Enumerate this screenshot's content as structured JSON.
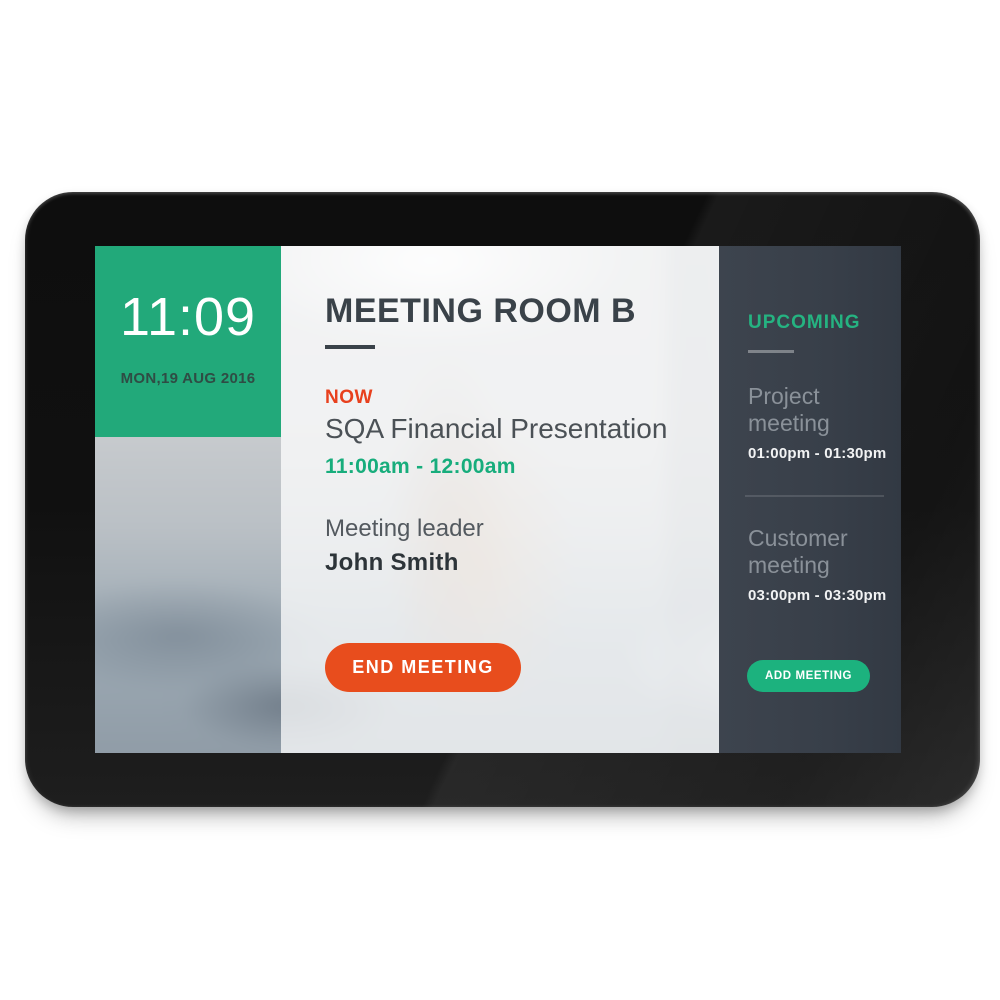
{
  "device": {
    "label": "meeting room booking display"
  },
  "clock": {
    "time": "11:09",
    "date": "MON,19 AUG 2016"
  },
  "room": {
    "title": "MEETING ROOM B"
  },
  "current_meeting": {
    "status_label": "NOW",
    "title": "SQA Financial Presentation",
    "time": "11:00am - 12:00am",
    "leader_label": "Meeting leader",
    "leader_name": "John Smith",
    "end_button_label": "END MEETING"
  },
  "upcoming": {
    "header": "UPCOMING",
    "meetings": [
      {
        "title": "Project meeting",
        "time": "01:00pm - 01:30pm"
      },
      {
        "title": "Customer meeting",
        "time": "03:00pm - 03:30pm"
      }
    ],
    "add_button_label": "ADD MEETING"
  },
  "colors": {
    "clock_panel_green": "#22a97a",
    "accent_green_text": "#17ad7c",
    "upcoming_green": "#25b381",
    "add_button_green": "#1cb27e",
    "now_red": "#e8401d",
    "end_button_red": "#e84d1d",
    "sidebar_dark": "#3a414b",
    "title_dark": "#3a4249",
    "bezel_black": "#101010"
  }
}
